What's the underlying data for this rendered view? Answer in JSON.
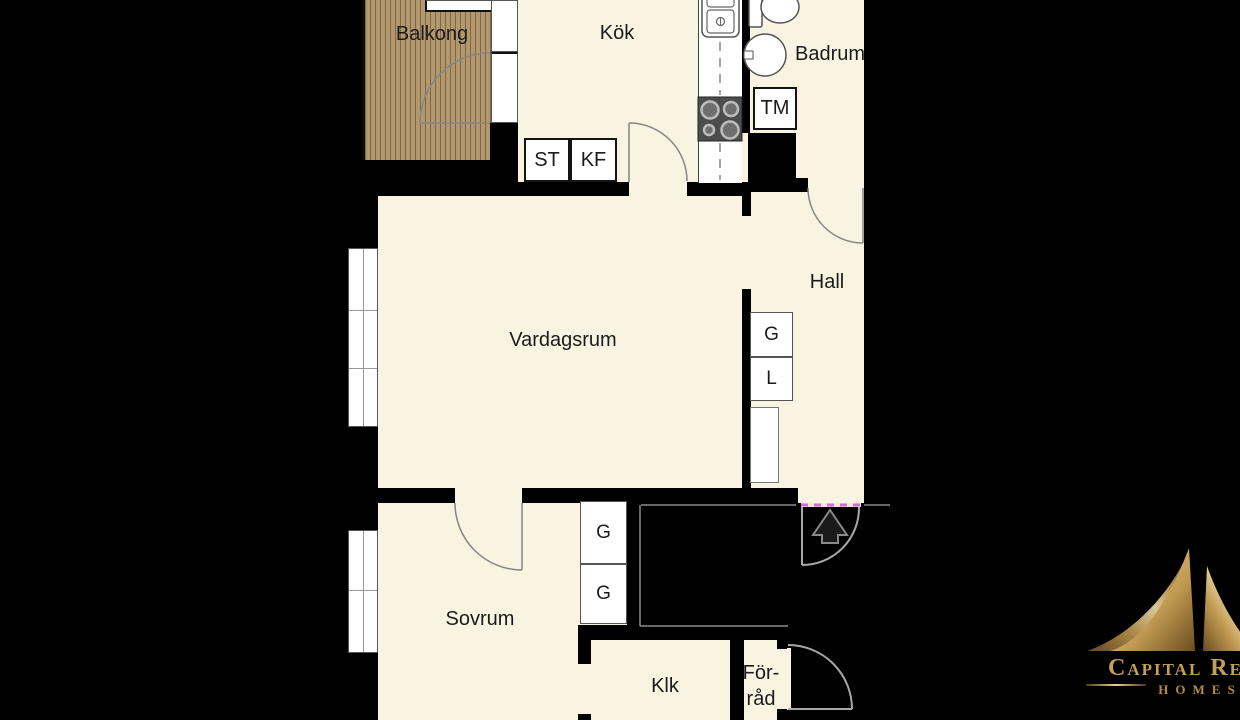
{
  "rooms": {
    "balkong": "Balkong",
    "kok": "Kök",
    "badrum": "Badrum",
    "hall": "Hall",
    "vardagsrum": "Vardagsrum",
    "sovrum": "Sovrum",
    "klk": "Klk",
    "forrad": {
      "line1": "För-",
      "line2": "råd"
    }
  },
  "fixtures": {
    "st": "ST",
    "kf": "KF",
    "tm": "TM",
    "hall_g": "G",
    "hall_l": "L",
    "sovrum_g_upper": "G",
    "sovrum_g_lower": "G"
  },
  "icons": {
    "entrance_arrow": "up-arrow",
    "logo_mark": "gold-mountain-peaks",
    "stove": "four-burner-stove",
    "sink": "double-basin-sink",
    "toilet": "toilet",
    "washbasin": "washbasin"
  },
  "logo": {
    "brand": "Capital Realty",
    "tagline": "Homes"
  },
  "colors": {
    "floor": "#F8F4E1",
    "wall": "#000000",
    "wood": "#B3986E",
    "accent_gold": "#C9A55C",
    "threshold": "#D86AD8",
    "background": "#000000"
  }
}
